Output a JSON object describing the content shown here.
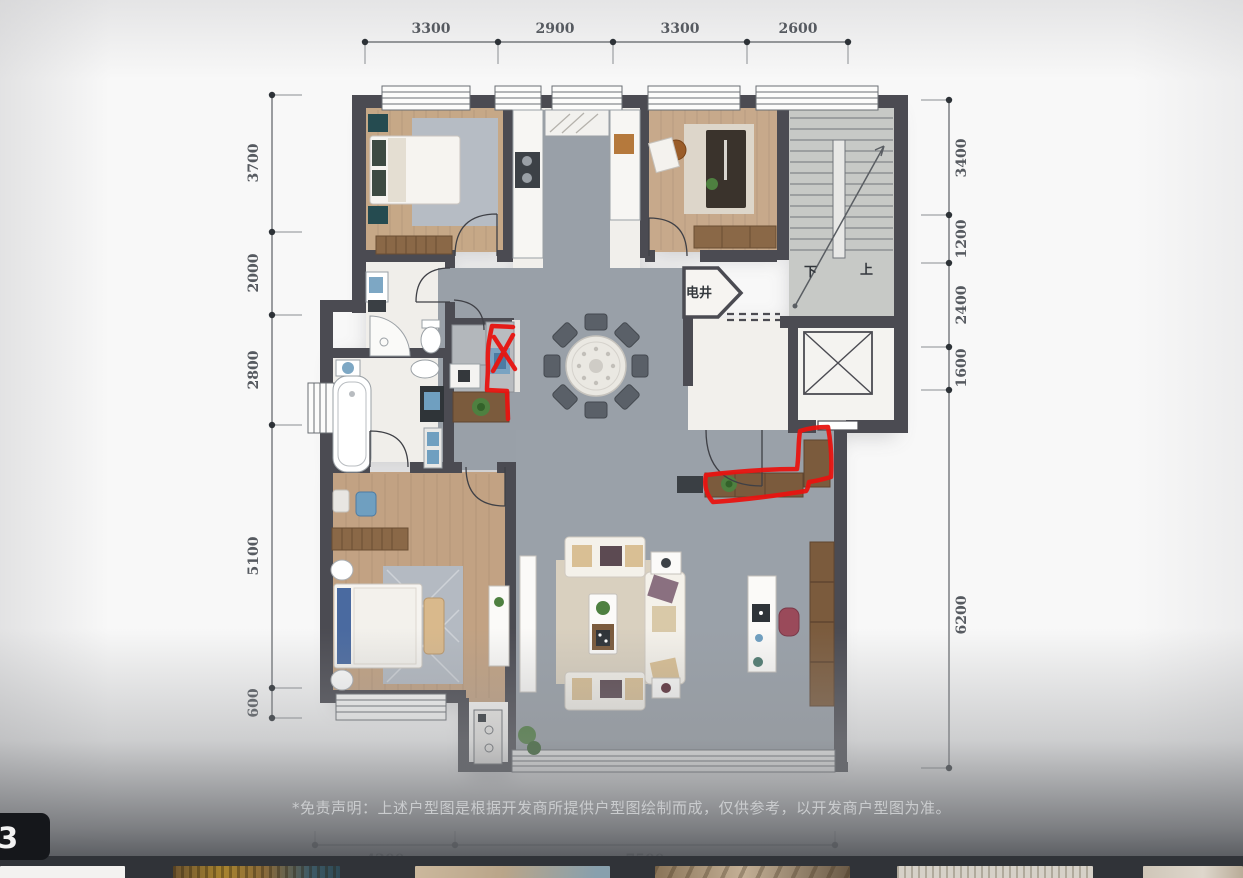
{
  "plan": {
    "dims": {
      "top": [
        "3300",
        "2900",
        "3300",
        "2600"
      ],
      "left": [
        "3700",
        "2000",
        "2800",
        "5100",
        "600"
      ],
      "right": [
        "3400",
        "1200",
        "2400",
        "1600",
        "6200"
      ],
      "bottom": [
        "4200",
        "7500"
      ]
    },
    "labels": {
      "shaft": "电井",
      "down": "下",
      "up": "上"
    },
    "annotations": {
      "color": "#e81410",
      "marks": [
        "red-x-over-laundry-niche",
        "red-outline-around-l-shaped-cabinet"
      ]
    },
    "colors": {
      "wall": "#4b4b52",
      "wood_floor": "#c5a687",
      "gray_floor": "#99a0a8",
      "tile_floor": "#f0eeea"
    }
  },
  "disclaimer": {
    "text": "*免责声明：上述户型图是根据开发商所提供户型图绘制而成，仅供参考，以开发商户型图为准。"
  },
  "badge": {
    "label": "3"
  },
  "film_strip": {
    "thumbnail_count": 6
  }
}
